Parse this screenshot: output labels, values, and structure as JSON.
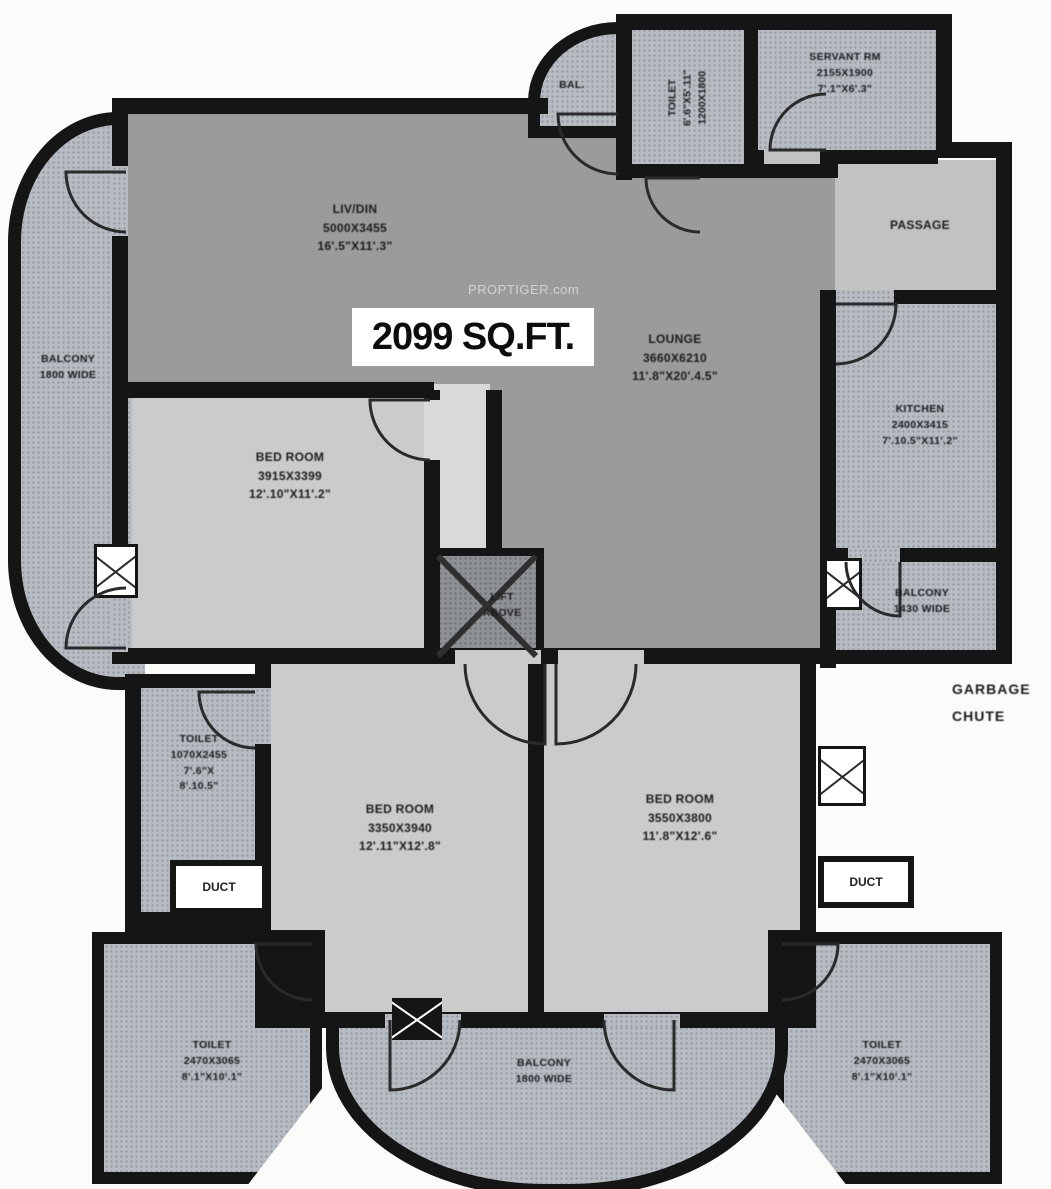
{
  "area_label": "2099 SQ.FT.",
  "watermark": "PROPTIGER.com",
  "colors": {
    "wall": "#151515",
    "living_lounge_fill": "#9b9b9b",
    "bedroom_fill": "#cbcbcb",
    "balcony_toilet_fill": "#b7bcc3",
    "passage_fill": "#c2c2c2",
    "area_box_bg": "#ffffff"
  },
  "rooms": {
    "living": {
      "name": "LIV/DIN",
      "mm": "5000X3455",
      "ft": "16'.5\"X11'.3\""
    },
    "lounge": {
      "name": "LOUNGE",
      "mm": "3660X6210",
      "ft": "11'.8\"X20'.4.5\""
    },
    "passage": {
      "name": "PASSAGE"
    },
    "kitchen": {
      "name": "KITCHEN",
      "mm": "2400X3415",
      "ft": "7'.10.5\"X11'.2\""
    },
    "servant": {
      "name": "SERVANT RM",
      "mm": "2155X1900",
      "ft": "7'.1\"X6'.3\""
    },
    "toilet_top": {
      "name": "TOILET",
      "ft": "6'.6\"X5'.11\"",
      "mm": "1200X1800"
    },
    "bal_top": {
      "name": "BAL."
    },
    "balcony_left": {
      "name": "BALCONY",
      "width_note": "1800 WIDE"
    },
    "balcony_right": {
      "name": "BALCONY",
      "width_note": "1430 WIDE"
    },
    "balcony_bottom": {
      "name": "BALCONY",
      "width_note": "1800 WIDE"
    },
    "bedroom1": {
      "name": "BED ROOM",
      "mm": "3915X3399",
      "ft": "12'.10\"X11'.2\""
    },
    "bedroom2": {
      "name": "BED ROOM",
      "mm": "3350X3940",
      "ft": "12'.11\"X12'.8\""
    },
    "bedroom3": {
      "name": "BED ROOM",
      "mm": "3550X3800",
      "ft": "11'.8\"X12'.6\""
    },
    "toilet_mid": {
      "name": "TOILET",
      "mm": "1070X2455",
      "ft1": "7'.6\"X",
      "ft2": "8'.10.5\""
    },
    "toilet_bottom_left": {
      "name": "TOILET",
      "mm": "2470X3065",
      "ft": "8'.1\"X10'.1\""
    },
    "toilet_bottom_right": {
      "name": "TOILET",
      "mm": "2470X3065",
      "ft": "8'.1\"X10'.1\""
    },
    "duct_left": {
      "name": "DUCT"
    },
    "duct_right": {
      "name": "DUCT"
    },
    "lift": {
      "line1": "LIFT",
      "line2": "ABOVE"
    },
    "garbage_chute": {
      "line1": "GARBAGE",
      "line2": "CHUTE"
    }
  }
}
